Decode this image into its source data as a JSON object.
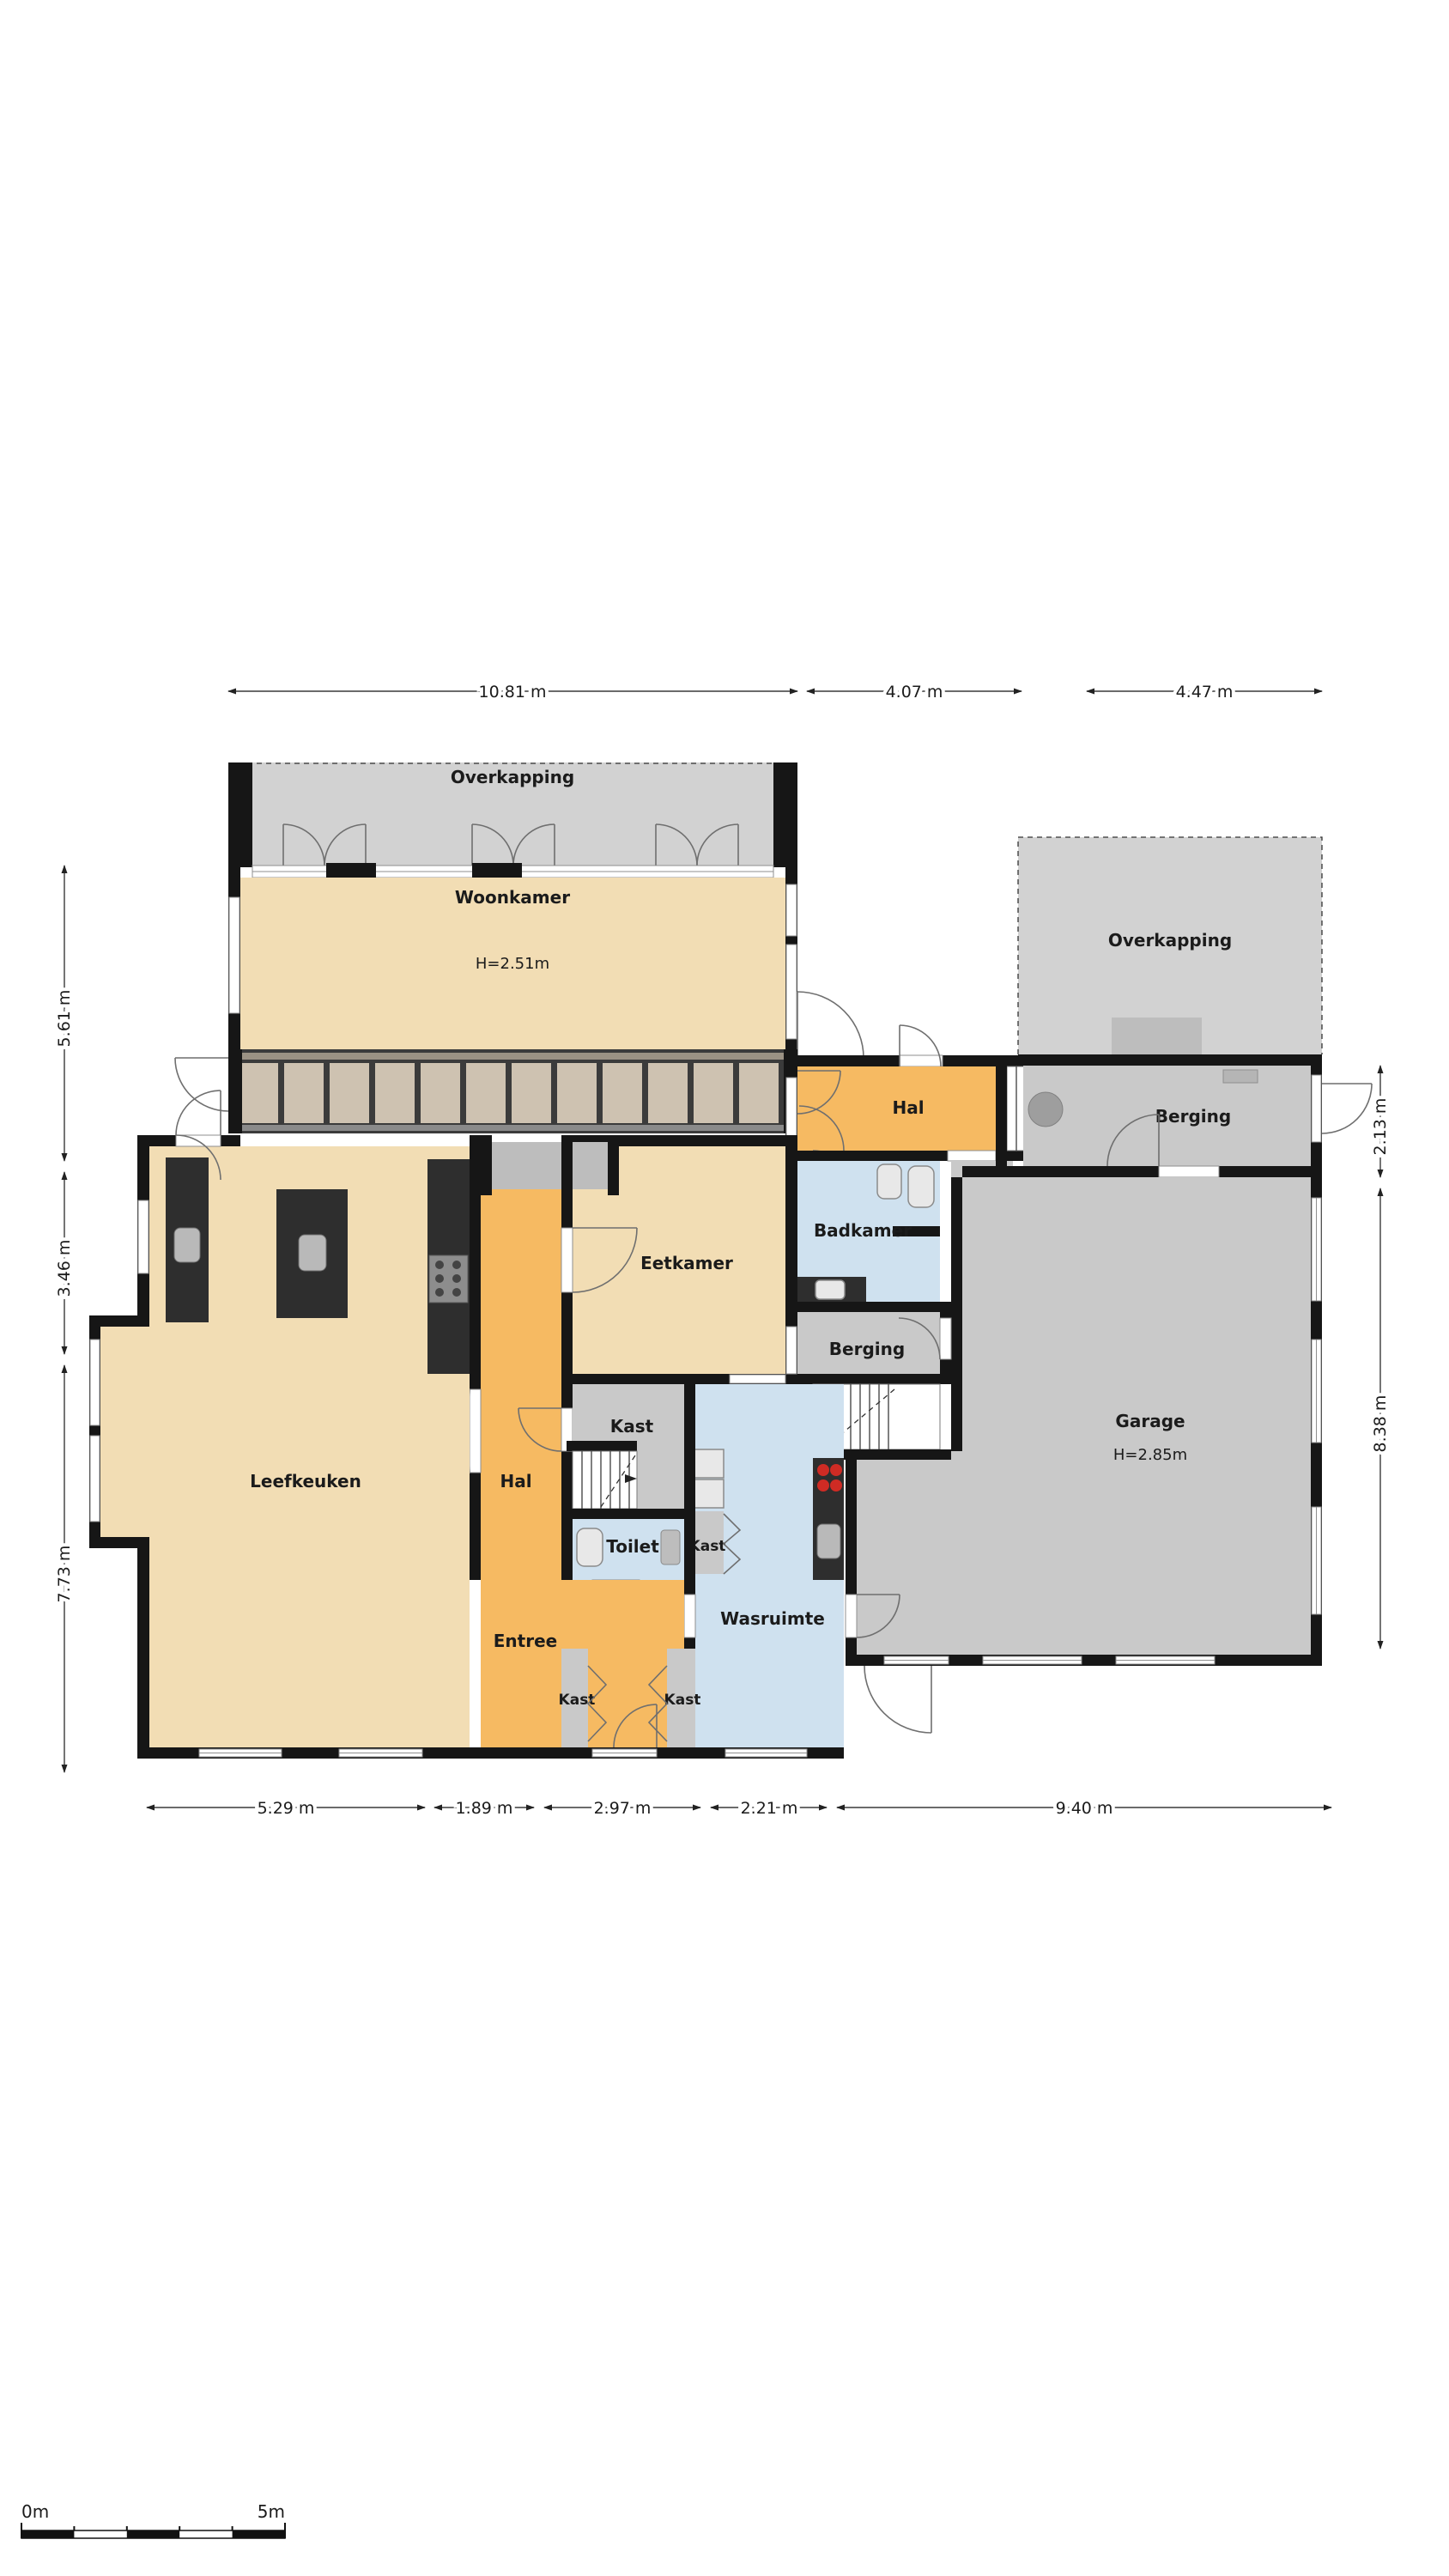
{
  "plan_title": "Begane grond plattegrond",
  "rooms": {
    "overkapping_top": {
      "label": "Overkapping"
    },
    "woonkamer": {
      "label": "Woonkamer",
      "height": "H=2.51m"
    },
    "overkapping_right": {
      "label": "Overkapping"
    },
    "hal_top": {
      "label": "Hal"
    },
    "kast_top": {
      "label": "Kast"
    },
    "berging_right": {
      "label": "Berging"
    },
    "badkamer": {
      "label": "Badkamer"
    },
    "berging_small": {
      "label": "Berging"
    },
    "garage": {
      "label": "Garage",
      "height": "H=2.85m"
    },
    "eetkamer": {
      "label": "Eetkamer"
    },
    "leefkeuken": {
      "label": "Leefkeuken"
    },
    "hal": {
      "label": "Hal"
    },
    "kast_mid": {
      "label": "Kast"
    },
    "toilet": {
      "label": "Toilet"
    },
    "kast_wasruimte": {
      "label": "Kast"
    },
    "wasruimte": {
      "label": "Wasruimte"
    },
    "entree": {
      "label": "Entree"
    },
    "kast_entree_left": {
      "label": "Kast"
    },
    "kast_entree_right": {
      "label": "Kast"
    }
  },
  "dimensions": {
    "top": [
      "10.81 m",
      "4.07 m",
      "4.47 m"
    ],
    "left": [
      "5.61 m",
      "3.46 m",
      "7.73 m"
    ],
    "right": [
      "2.13 m",
      "8.38 m"
    ],
    "bottom": [
      "5.29 m",
      "1.89 m",
      "2.97 m",
      "2.21 m",
      "9.40 m"
    ]
  },
  "scale_bar": {
    "start": "0m",
    "end": "5m"
  },
  "colors": {
    "room_beige": "#f2ddb4",
    "room_orange": "#f6ba62",
    "room_blue": "#cfe1ef",
    "room_gray": "#c9c9c9",
    "overkapping": "#d2d2d2",
    "wall": "#161616",
    "counter": "#2e2e2e",
    "panel": "#cec2b1",
    "mat": "#bdbdbd"
  }
}
